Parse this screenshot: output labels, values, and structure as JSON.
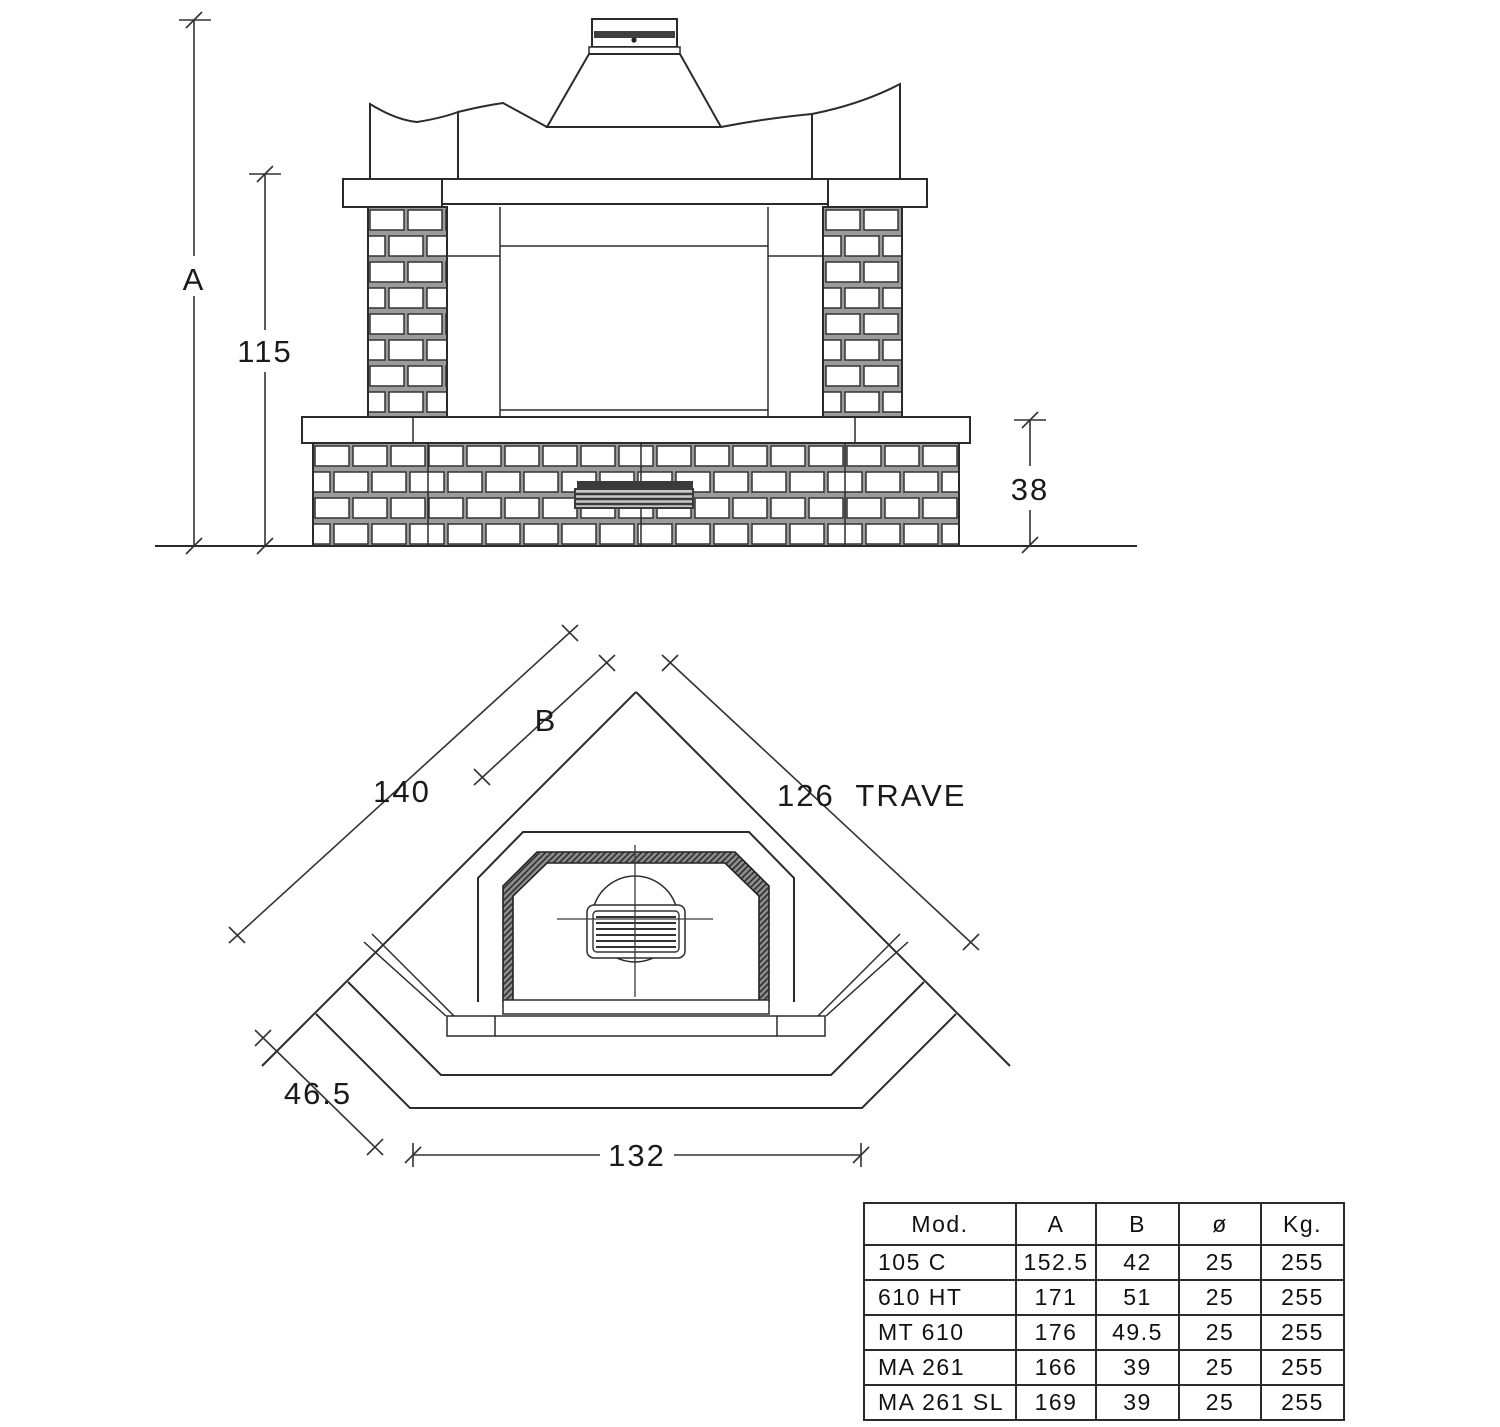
{
  "colors": {
    "line": "#2b2b2b",
    "background": "#ffffff",
    "grate": "#3a3a3a",
    "mortar": "#9b9b9b"
  },
  "elevation": {
    "dim_height_total": "A",
    "dim_height_shelf": "115",
    "dim_height_hearth": "38"
  },
  "plan": {
    "dim_side_total": "140",
    "dim_side_b": "B",
    "dim_beam": "126  TRAVE",
    "dim_side_depth": "46.5",
    "dim_front_width": "132"
  },
  "table": {
    "headers": [
      "Mod.",
      "A",
      "B",
      "ø",
      "Kg."
    ],
    "rows": [
      [
        "105 C",
        "152.5",
        "42",
        "25",
        "255"
      ],
      [
        "610 HT",
        "171",
        "51",
        "25",
        "255"
      ],
      [
        "MT 610",
        "176",
        "49.5",
        "25",
        "255"
      ],
      [
        "MA 261",
        "166",
        "39",
        "25",
        "255"
      ],
      [
        "MA 261 SL",
        "169",
        "39",
        "25",
        "255"
      ]
    ]
  }
}
